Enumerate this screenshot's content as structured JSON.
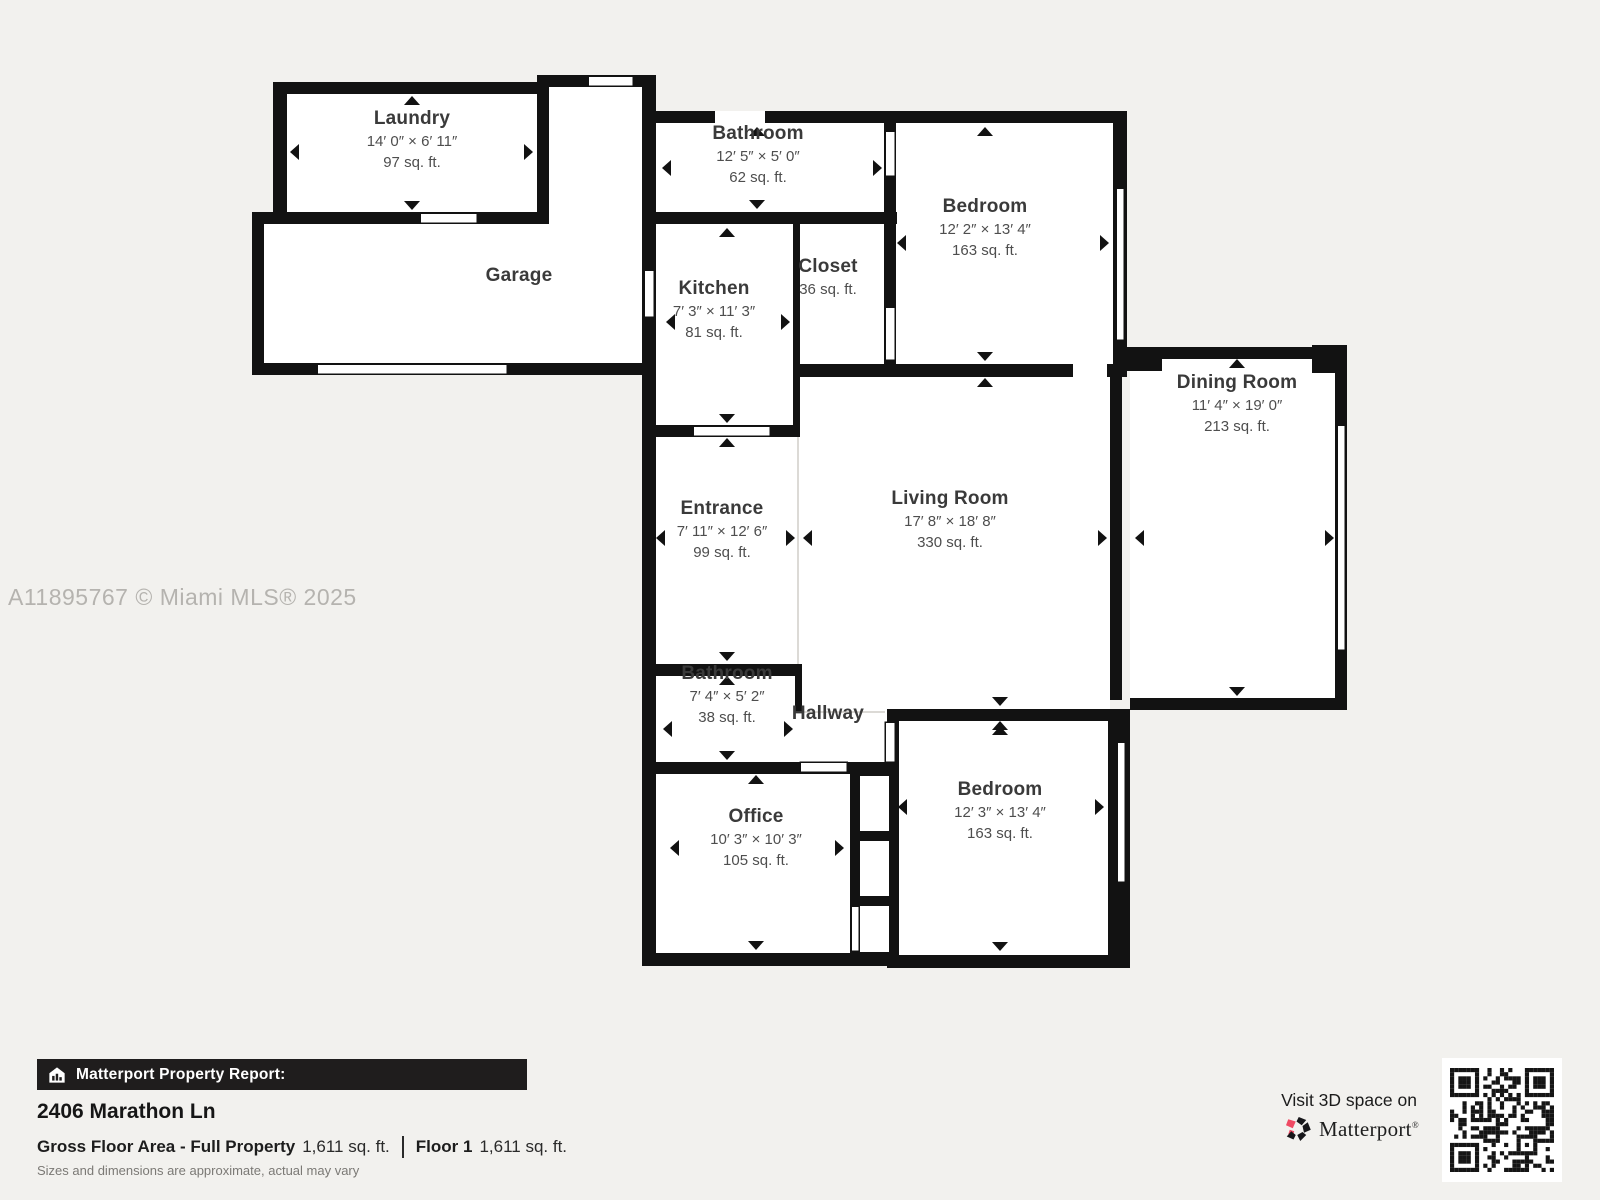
{
  "watermark": "A11895767 © Miami MLS® 2025",
  "rooms": [
    {
      "id": "laundry",
      "name": "Laundry",
      "dims": "14′ 0″ × 6′ 11″",
      "area": "97 sq. ft."
    },
    {
      "id": "garage",
      "name": "Garage"
    },
    {
      "id": "bathroom-top",
      "name": "Bathroom",
      "dims": "12′ 5″ × 5′ 0″",
      "area": "62 sq. ft."
    },
    {
      "id": "bedroom-top",
      "name": "Bedroom",
      "dims": "12′ 2″ × 13′ 4″",
      "area": "163 sq. ft."
    },
    {
      "id": "kitchen",
      "name": "Kitchen",
      "dims": "7′ 3″ × 11′ 3″",
      "area": "81 sq. ft."
    },
    {
      "id": "closet",
      "name": "Closet",
      "area": "36 sq. ft."
    },
    {
      "id": "dining-room",
      "name": "Dining Room",
      "dims": "11′ 4″ × 19′ 0″",
      "area": "213 sq. ft."
    },
    {
      "id": "entrance",
      "name": "Entrance",
      "dims": "7′ 11″ × 12′ 6″",
      "area": "99 sq. ft."
    },
    {
      "id": "living-room",
      "name": "Living Room",
      "dims": "17′ 8″ × 18′ 8″",
      "area": "330 sq. ft."
    },
    {
      "id": "bathroom-lower",
      "name": "Bathroom",
      "dims": "7′ 4″ × 5′ 2″",
      "area": "38 sq. ft."
    },
    {
      "id": "hallway",
      "name": "Hallway"
    },
    {
      "id": "office",
      "name": "Office",
      "dims": "10′ 3″ × 10′ 3″",
      "area": "105 sq. ft."
    },
    {
      "id": "bedroom-lower",
      "name": "Bedroom",
      "dims": "12′ 3″ × 13′ 4″",
      "area": "163 sq. ft."
    }
  ],
  "footer": {
    "report_label": "Matterport Property Report:",
    "address": "2406 Marathon Ln",
    "gross_label": "Gross Floor Area - Full Property",
    "gross_value": "1,611 sq. ft.",
    "floor_label": "Floor 1",
    "floor_value": "1,611 sq. ft.",
    "disclaimer": "Sizes and dimensions are approximate, actual may vary"
  },
  "branding": {
    "visit_text": "Visit 3D space on",
    "wordmark": "Matterport",
    "registered": "®"
  },
  "colors": {
    "background": "#f2f1ee",
    "wall": "#121212",
    "floor": "#ffffff",
    "footer_bar": "#1f1d1d",
    "brand_pink": "#ef4a63",
    "watermark_gray": "#b5b3af"
  }
}
